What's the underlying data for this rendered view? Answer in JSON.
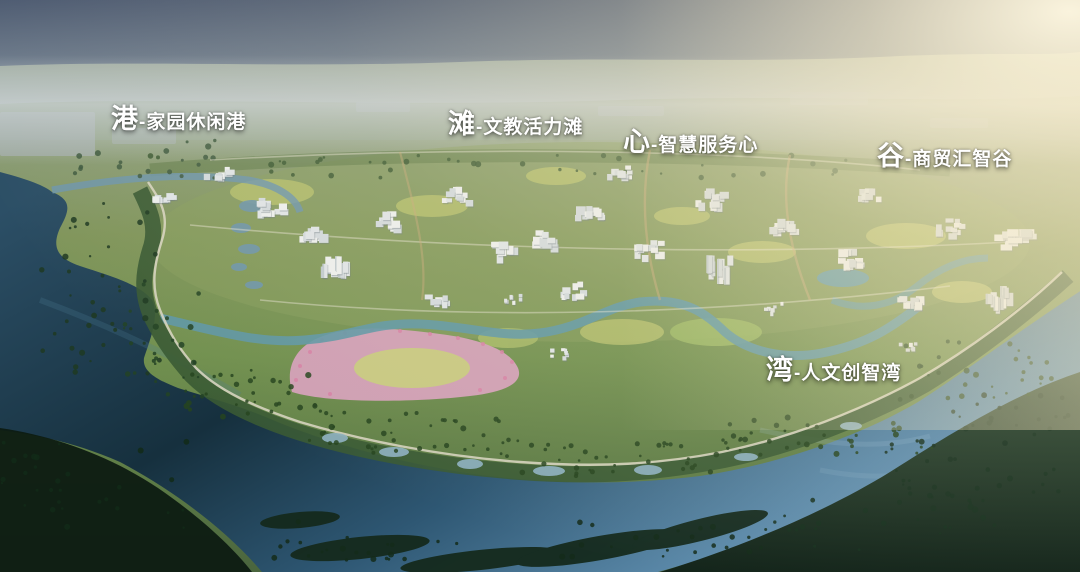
{
  "scene": {
    "district_labels": [
      {
        "key": "gang",
        "big": "港",
        "rest": "-家园休闲港",
        "full": "港-家园休闲港"
      },
      {
        "key": "tan",
        "big": "滩",
        "rest": "-文教活力滩",
        "full": "滩-文教活力滩"
      },
      {
        "key": "xin",
        "big": "心",
        "rest": "-智慧服务心",
        "full": "心-智慧服务心"
      },
      {
        "key": "gu",
        "big": "谷",
        "rest": "-商贸汇智谷",
        "full": "谷-商贸汇智谷"
      },
      {
        "key": "wan",
        "big": "湾",
        "rest": "-人文创智湾",
        "full": "湾-人文创智湾"
      }
    ],
    "colors": {
      "label_text": "#ffffff",
      "sky_top": "#4c5a71",
      "horizon_haze": "#cbd2d7",
      "sun_glow": "#f8ecca",
      "land_green": "#71904f",
      "field_yellow": "#b5bf6d",
      "flower_pink": "#cf9fb4",
      "river_blue": "#5b89a9",
      "water_dark": "#16303e",
      "forest_dark": "#0d1b12",
      "building_white": "#e6eaec"
    }
  }
}
